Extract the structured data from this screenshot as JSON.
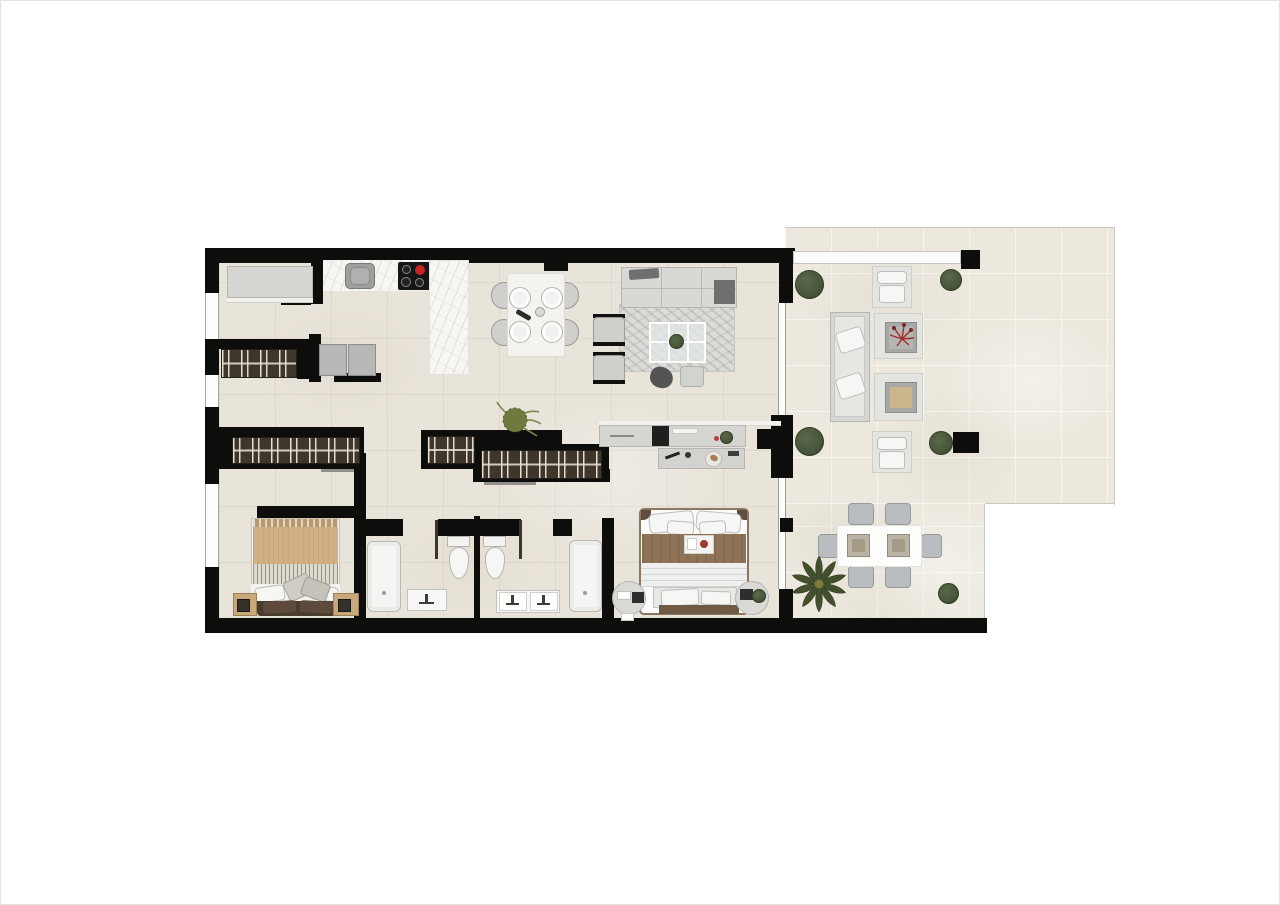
{
  "scene": {
    "name": "apartment-floor-plan",
    "view": "top-down-render",
    "visible_text": "none"
  },
  "palette": {
    "wall": "#0d0d0c",
    "interior_floor": "#e9e4da",
    "terrace_floor": "#ece8de",
    "marble_counter": "#f7f6f3",
    "wardrobe_wood": "#3f362b",
    "hob_burner_red": "#c62525",
    "foliage_green": "#46543a",
    "bed_throw_tan": "#d3b084",
    "bed_throw_brown": "#8f7356",
    "furniture_gray": "#d6d6d3",
    "paper_background": "#ffffff"
  },
  "rooms": [
    {
      "name": "entry",
      "furniture": [
        "console-cabinet"
      ]
    },
    {
      "name": "laundry",
      "furniture": [
        "wardrobe",
        "washer",
        "dryer"
      ]
    },
    {
      "name": "kitchen",
      "furniture": [
        "countertop",
        "sink",
        "induction-hob",
        "kitchen-island"
      ]
    },
    {
      "name": "dining-area",
      "furniture": [
        "dining-table",
        "chair",
        "chair",
        "chair",
        "chair",
        "plate-setting-x4",
        "wine-bottle",
        "decanter"
      ]
    },
    {
      "name": "living-room",
      "furniture": [
        "sofa",
        "armchair",
        "armchair",
        "glass-coffee-table",
        "rug",
        "pouf",
        "dark-pouf",
        "side-tray-table",
        "tv-sideboard",
        "potted-plant"
      ]
    },
    {
      "name": "hallway",
      "furniture": [
        "wardrobe",
        "wardrobe",
        "wardrobe",
        "fern-plant"
      ]
    },
    {
      "name": "bedroom-2",
      "furniture": [
        "double-bed",
        "nightstand",
        "nightstand",
        "lamp",
        "lamp"
      ]
    },
    {
      "name": "bathroom-1",
      "furniture": [
        "bathtub",
        "toilet",
        "washbasin"
      ]
    },
    {
      "name": "bathroom-2",
      "furniture": [
        "toilet",
        "double-washbasin",
        "bathtub"
      ]
    },
    {
      "name": "master-bedroom",
      "furniture": [
        "double-bed",
        "breakfast-tray",
        "foot-bench",
        "round-nightstand",
        "round-nightstand",
        "dresser"
      ]
    },
    {
      "name": "terrace-lounge",
      "furniture": [
        "outdoor-armchair",
        "outdoor-armchair",
        "outdoor-sofa",
        "coffee-table-red-plant",
        "coffee-table-tray",
        "bush",
        "bush",
        "bush",
        "bush"
      ]
    },
    {
      "name": "terrace-dining",
      "furniture": [
        "outdoor-table",
        "outdoor-chair-x6",
        "placemat",
        "placemat",
        "palm-plant",
        "bush"
      ]
    }
  ]
}
